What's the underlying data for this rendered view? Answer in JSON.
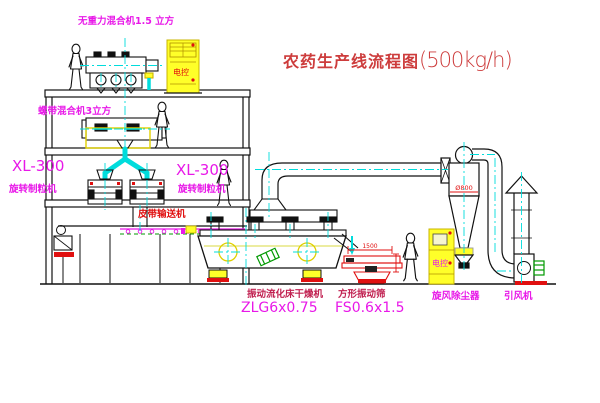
{
  "title": {
    "cn": "农药生产线流程图",
    "spec": "(500kg/h)"
  },
  "equipment_labels": {
    "top_mixer": "无重力混合机1.5 立方",
    "mid_mixer": "螺带混合机3立方",
    "granulator_left": {
      "model": "XL-300",
      "name": "旋转制粒机"
    },
    "granulator_right": {
      "model": "XL-300",
      "name": "旋转制粒机"
    },
    "belt_conveyor": "皮带输送机",
    "fluid_bed_dryer": {
      "name": "振动流化床干燥机",
      "model": "ZLG6x0.75"
    },
    "square_screen": {
      "name": "方形振动筛",
      "model": "FS0.6x1.5"
    },
    "cyclone": "旋风除尘器",
    "induced_fan": "引风机"
  },
  "annotations": {
    "cyclone_diameter": "Ø800",
    "screen_length_dim": "1500",
    "cabinet_top": "电控",
    "cabinet_right": "电控"
  },
  "colors": {
    "label_magenta": "#e818e8",
    "label_red": "#e01010",
    "title_red": "#cd3c3c",
    "name_crimson": "#c02050",
    "centerline_cyan": "#00dcdc",
    "machine_green": "#009900",
    "cabinet_yellow": "#ffff29"
  }
}
